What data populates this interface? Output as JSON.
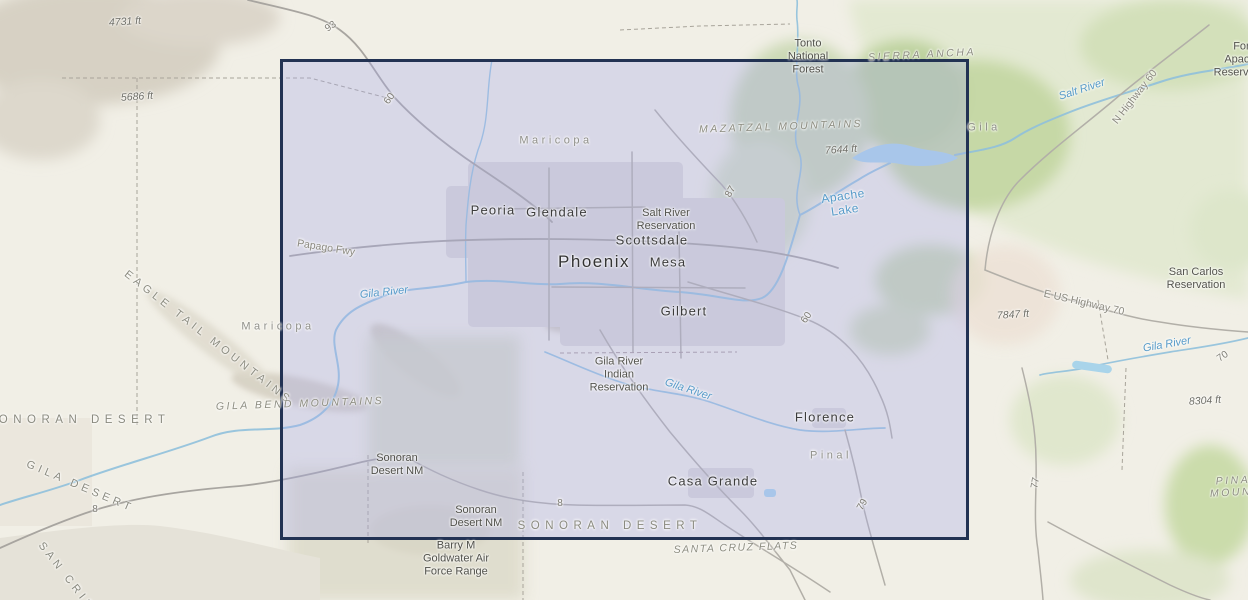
{
  "map": {
    "width": 1248,
    "height": 600,
    "colors": {
      "background": "#f1efe6",
      "selection_fill": "rgba(167,171,233,0.33)",
      "selection_border": "#223253",
      "water_line": "#8fc0dc",
      "water_fill": "#a9d4ea",
      "road": "#b2afa8",
      "forest_green": "#c6d8a6",
      "urban_gray": "#dbd9d5"
    },
    "selection": {
      "x": 280,
      "y": 59,
      "width": 689,
      "height": 481
    },
    "labels": [
      {
        "t": "4731 ft",
        "x": 125,
        "y": 22,
        "c": "elevation",
        "r": -4
      },
      {
        "t": "93",
        "x": 331,
        "y": 27,
        "c": "road-num",
        "r": -35
      },
      {
        "t": "Tonto\nNational\nForest",
        "x": 808,
        "y": 57,
        "c": "poi"
      },
      {
        "t": "SIERRA ANCHA",
        "x": 922,
        "y": 55,
        "c": "range",
        "r": -3
      },
      {
        "t": "Fort Apache\nReservation",
        "x": 1243,
        "y": 60,
        "c": "reservation"
      },
      {
        "t": "Salt River",
        "x": 1082,
        "y": 90,
        "c": "river",
        "r": -18
      },
      {
        "t": "N Highway 60",
        "x": 1135,
        "y": 97,
        "c": "road-name",
        "r": -52
      },
      {
        "t": "5686 ft",
        "x": 137,
        "y": 97,
        "c": "elevation",
        "r": -4
      },
      {
        "t": "60",
        "x": 390,
        "y": 99,
        "c": "road-num",
        "r": -55
      },
      {
        "t": "Gila",
        "x": 984,
        "y": 128,
        "c": "county"
      },
      {
        "t": "MAZATZAL MOUNTAINS",
        "x": 781,
        "y": 127,
        "c": "range",
        "r": -2
      },
      {
        "t": "Maricopa",
        "x": 556,
        "y": 141,
        "c": "county"
      },
      {
        "t": "7644 ft",
        "x": 841,
        "y": 150,
        "c": "elevation",
        "r": -4
      },
      {
        "t": "87",
        "x": 731,
        "y": 192,
        "c": "road-num",
        "r": -60
      },
      {
        "t": "Apache\nLake",
        "x": 844,
        "y": 203,
        "c": "lake",
        "r": -8
      },
      {
        "t": "Peoria",
        "x": 493,
        "y": 210,
        "c": "city"
      },
      {
        "t": "Glendale",
        "x": 557,
        "y": 212,
        "c": "city"
      },
      {
        "t": "Salt River\nReservation",
        "x": 666,
        "y": 220,
        "c": "reservation"
      },
      {
        "t": "Scottsdale",
        "x": 652,
        "y": 240,
        "c": "city"
      },
      {
        "t": "Papago Fwy",
        "x": 326,
        "y": 248,
        "c": "road-name",
        "r": 9
      },
      {
        "t": "Phoenix",
        "x": 594,
        "y": 262,
        "c": "city-major"
      },
      {
        "t": "Mesa",
        "x": 668,
        "y": 262,
        "c": "city"
      },
      {
        "t": "San Carlos\nReservation",
        "x": 1196,
        "y": 279,
        "c": "reservation"
      },
      {
        "t": "Gila River",
        "x": 384,
        "y": 293,
        "c": "river",
        "r": -6
      },
      {
        "t": "E US Highway 70",
        "x": 1084,
        "y": 303,
        "c": "road-name",
        "r": 13
      },
      {
        "t": "Gilbert",
        "x": 684,
        "y": 311,
        "c": "city"
      },
      {
        "t": "7847 ft",
        "x": 1013,
        "y": 315,
        "c": "elevation",
        "r": -4
      },
      {
        "t": "60",
        "x": 807,
        "y": 318,
        "c": "road-num",
        "r": -55
      },
      {
        "t": "Maricopa",
        "x": 278,
        "y": 327,
        "c": "county"
      },
      {
        "t": "EAGLE TAIL MOUNTAINS",
        "x": 208,
        "y": 338,
        "c": "range-diag",
        "r": 38
      },
      {
        "t": "Gila River",
        "x": 1167,
        "y": 345,
        "c": "river",
        "r": -10
      },
      {
        "t": "70",
        "x": 1223,
        "y": 357,
        "c": "road-num",
        "r": -35
      },
      {
        "t": "Gila River\nIndian\nReservation",
        "x": 619,
        "y": 375,
        "c": "reservation"
      },
      {
        "t": "Gila River",
        "x": 688,
        "y": 390,
        "c": "river",
        "r": 18
      },
      {
        "t": "GILA BEND MOUNTAINS",
        "x": 300,
        "y": 404,
        "c": "range",
        "r": -2
      },
      {
        "t": "8304 ft",
        "x": 1205,
        "y": 401,
        "c": "elevation",
        "r": -4
      },
      {
        "t": "Florence",
        "x": 825,
        "y": 417,
        "c": "city"
      },
      {
        "t": "SONORAN DESERT",
        "x": 78,
        "y": 421,
        "c": "desert"
      },
      {
        "t": "Pinal",
        "x": 831,
        "y": 456,
        "c": "county"
      },
      {
        "t": "Sonoran\nDesert NM",
        "x": 397,
        "y": 465,
        "c": "poi"
      },
      {
        "t": "Casa Grande",
        "x": 713,
        "y": 481,
        "c": "city"
      },
      {
        "t": "77",
        "x": 1036,
        "y": 483,
        "c": "road-num",
        "r": -80
      },
      {
        "t": "PINALENA MOUNTAINS",
        "x": 1252,
        "y": 486,
        "c": "range",
        "r": -3
      },
      {
        "t": "GILA DESERT",
        "x": 80,
        "y": 487,
        "c": "desert-diag",
        "r": 23
      },
      {
        "t": "79",
        "x": 863,
        "y": 505,
        "c": "road-num",
        "r": -60
      },
      {
        "t": "8",
        "x": 95,
        "y": 510,
        "c": "road-num"
      },
      {
        "t": "8",
        "x": 560,
        "y": 504,
        "c": "road-num"
      },
      {
        "t": "Sonoran\nDesert NM",
        "x": 476,
        "y": 517,
        "c": "poi"
      },
      {
        "t": "SONORAN DESERT",
        "x": 610,
        "y": 527,
        "c": "desert"
      },
      {
        "t": "SANTA CRUZ FLATS",
        "x": 736,
        "y": 548,
        "c": "flats",
        "r": -2
      },
      {
        "t": "Barry M\nGoldwater Air\nForce Range",
        "x": 456,
        "y": 559,
        "c": "poi"
      },
      {
        "t": "SAN CRIS",
        "x": 66,
        "y": 577,
        "c": "desert-diag",
        "r": 52
      }
    ]
  }
}
